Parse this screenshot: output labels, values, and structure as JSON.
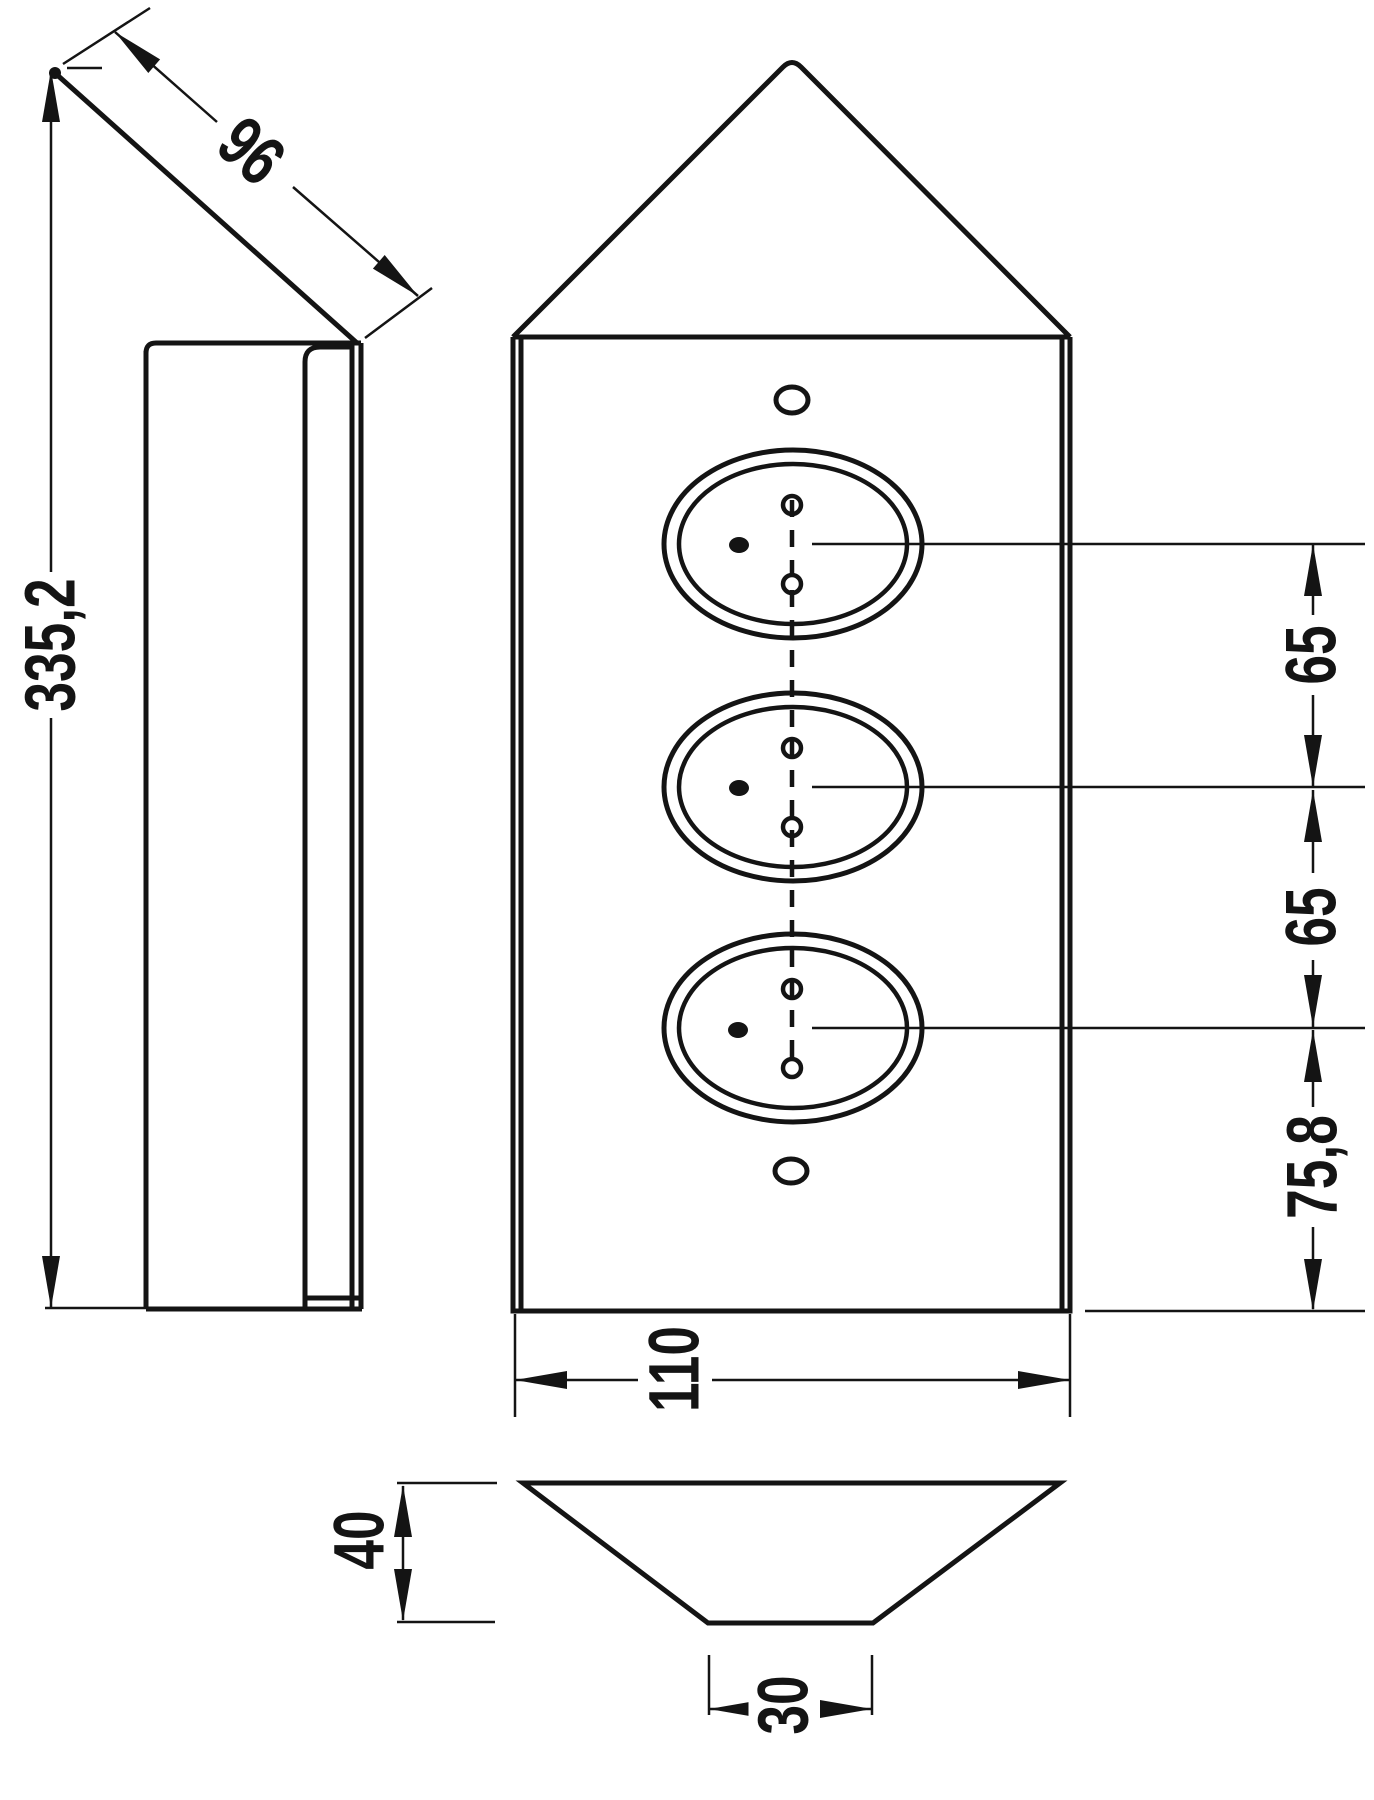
{
  "drawing": {
    "type": "technical-dimension-drawing",
    "subject": "corner-mounted triple socket unit, three orthographic views",
    "units_implied": "mm",
    "colors": {
      "line": "#141414",
      "background": "#ffffff"
    }
  },
  "dims": {
    "total_height": "335,2",
    "slant_length": "96",
    "front_width": "110",
    "socket_spacing_upper": "65",
    "socket_spacing_lower": "65",
    "bottom_socket_offset": "75,8",
    "profile_depth": "40",
    "base_width": "30"
  }
}
